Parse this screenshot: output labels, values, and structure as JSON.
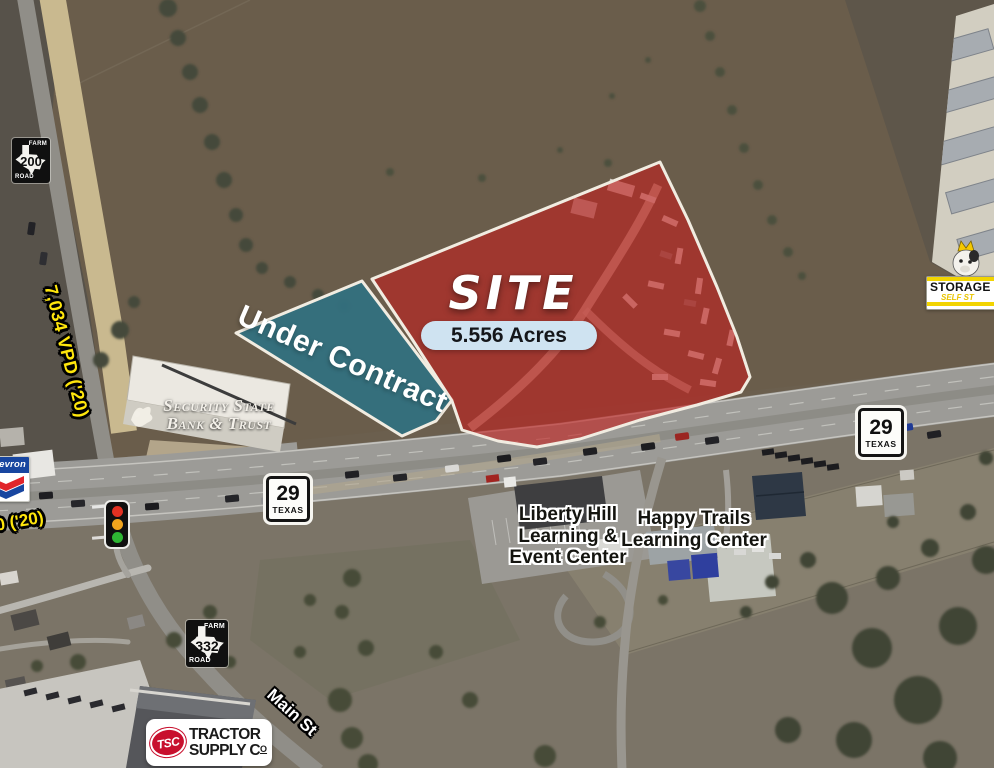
{
  "overlay": {
    "site_label": "SITE",
    "acreage": "5.556 Acres",
    "under_contract": "Under Contract"
  },
  "traffic_counts": {
    "hwy29_vpd": "7,034 VPD ('20)",
    "partial_vpd": "0 ('20)"
  },
  "shields": {
    "fm200": {
      "top": "FARM",
      "number": "200",
      "bottom": "ROAD"
    },
    "fm332": {
      "top": "FARM",
      "number": "332",
      "bottom": "ROAD"
    },
    "tx29_west": {
      "number": "29",
      "state": "TEXAS"
    },
    "tx29_east": {
      "number": "29",
      "state": "TEXAS"
    }
  },
  "places": {
    "bank_line1": "Security State",
    "bank_line2": "Bank & Trust",
    "liberty_line1": "Liberty Hill",
    "liberty_line2": "Learning &",
    "liberty_line3": "Event Center",
    "happy_line1": "Happy Trails",
    "happy_line2": "Learning Center",
    "main_st": "Main St",
    "storage_line1": "STORAGE K",
    "storage_line2": "SELF ST",
    "tsc_abbrev": "TSC",
    "tractor_line1": "TRACTOR",
    "tractor_line2": "SUPPLY C",
    "tractor_co": "O",
    "chevron": "Chevron"
  },
  "colors": {
    "site_fill": "#C0211E",
    "contract_fill": "#33707E",
    "acreage_pill": "#CFE3F1",
    "vpd_text": "#FFE60C"
  }
}
